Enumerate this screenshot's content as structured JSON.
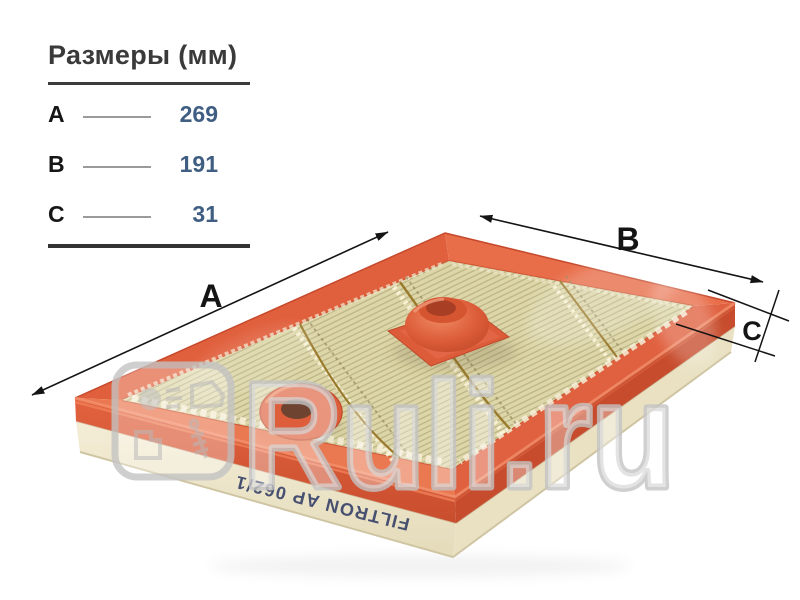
{
  "panel": {
    "title": "Размеры (мм)",
    "rows": [
      {
        "label": "A",
        "value": "269"
      },
      {
        "label": "B",
        "value": "191"
      },
      {
        "label": "C",
        "value": "31"
      }
    ]
  },
  "figure": {
    "dimension_labels": {
      "a": "A",
      "b": "B",
      "c": "C"
    },
    "part_print": "FILTRON AP 062/1",
    "product": "engine air filter, orange polyurethane frame, pleated paper media"
  },
  "watermark": {
    "text": "Ruli.ru"
  },
  "colors": {
    "frame_orange": "#e0613e",
    "frame_shadow": "#c74c2d",
    "media_cream": "#ddd6a8",
    "underside_cream": "#f2ebd2",
    "value_blue": "#3f5e82",
    "annotation_black": "#141414",
    "watermark_gray": "#c4c4c4",
    "print_navy": "#2c3763"
  }
}
